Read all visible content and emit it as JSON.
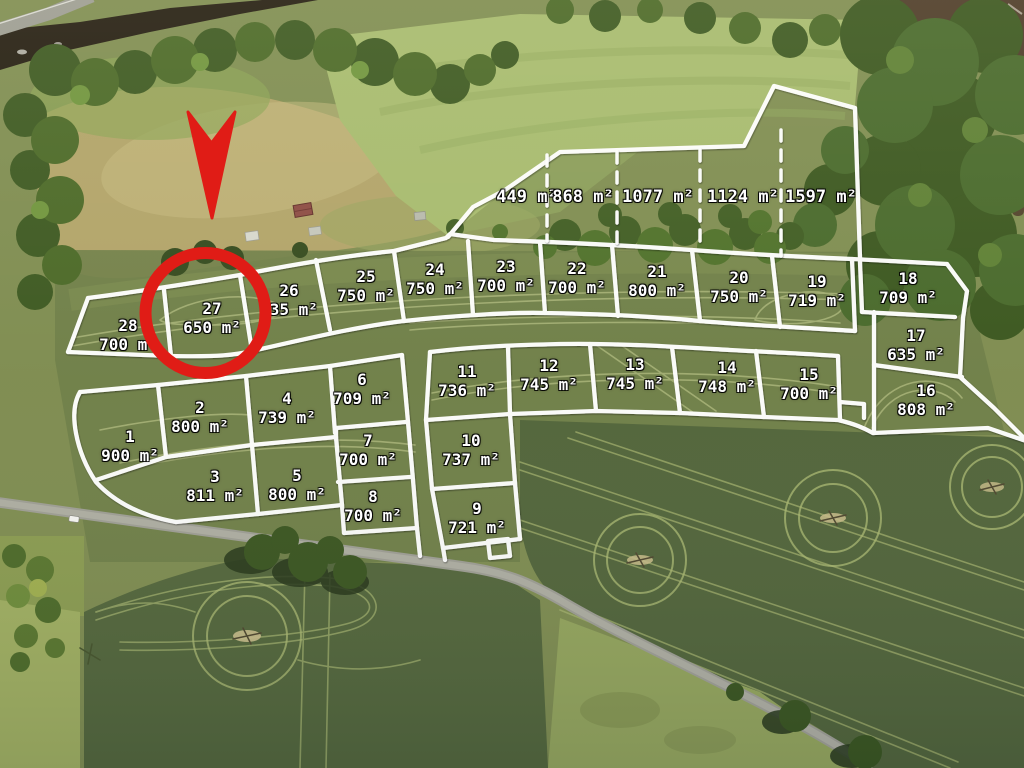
{
  "scene": {
    "highlighted_plot": "27",
    "marker_color": "#e01c16",
    "boundary_color": "#ffffff",
    "unit": "m²"
  },
  "plots": [
    {
      "number": "1",
      "area": "900 m²",
      "x": 130,
      "y": 446
    },
    {
      "number": "2",
      "area": "800 m²",
      "x": 200,
      "y": 417
    },
    {
      "number": "3",
      "area": "811 m²",
      "x": 215,
      "y": 486
    },
    {
      "number": "4",
      "area": "739 m²",
      "x": 287,
      "y": 408
    },
    {
      "number": "5",
      "area": "800 m²",
      "x": 297,
      "y": 485
    },
    {
      "number": "6",
      "area": "709 m²",
      "x": 362,
      "y": 389
    },
    {
      "number": "7",
      "area": "700 m²",
      "x": 368,
      "y": 450
    },
    {
      "number": "8",
      "area": "700 m²",
      "x": 373,
      "y": 506
    },
    {
      "number": "9",
      "area": "721 m²",
      "x": 477,
      "y": 518
    },
    {
      "number": "10",
      "area": "737 m²",
      "x": 471,
      "y": 450
    },
    {
      "number": "11",
      "area": "736 m²",
      "x": 467,
      "y": 381
    },
    {
      "number": "12",
      "area": "745 m²",
      "x": 549,
      "y": 375
    },
    {
      "number": "13",
      "area": "745 m²",
      "x": 635,
      "y": 374
    },
    {
      "number": "14",
      "area": "748 m²",
      "x": 727,
      "y": 377
    },
    {
      "number": "15",
      "area": "700 m²",
      "x": 809,
      "y": 384
    },
    {
      "number": "16",
      "area": "808 m²",
      "x": 926,
      "y": 400
    },
    {
      "number": "17",
      "area": "635 m²",
      "x": 916,
      "y": 345
    },
    {
      "number": "18",
      "area": "709 m²",
      "x": 908,
      "y": 288
    },
    {
      "number": "19",
      "area": "719 m²",
      "x": 817,
      "y": 291
    },
    {
      "number": "20",
      "area": "750 m²",
      "x": 739,
      "y": 287
    },
    {
      "number": "21",
      "area": "800 m²",
      "x": 657,
      "y": 281
    },
    {
      "number": "22",
      "area": "700 m²",
      "x": 577,
      "y": 278
    },
    {
      "number": "23",
      "area": "700 m²",
      "x": 506,
      "y": 276
    },
    {
      "number": "24",
      "area": "750 m²",
      "x": 435,
      "y": 279
    },
    {
      "number": "25",
      "area": "750 m²",
      "x": 366,
      "y": 286
    },
    {
      "number": "26",
      "area": "735 m²",
      "x": 289,
      "y": 300
    },
    {
      "number": "27",
      "area": "650 m²",
      "x": 212,
      "y": 318
    },
    {
      "number": "28",
      "area": "700 m²",
      "x": 128,
      "y": 335
    }
  ],
  "strip_parcels": [
    {
      "area": "449 m²",
      "x": 527,
      "y": 197
    },
    {
      "area": "868 m²",
      "x": 583,
      "y": 197
    },
    {
      "area": "1077 m²",
      "x": 658,
      "y": 197
    },
    {
      "area": "1124 m²",
      "x": 743,
      "y": 197
    },
    {
      "area": "1597 m²",
      "x": 821,
      "y": 197
    }
  ]
}
